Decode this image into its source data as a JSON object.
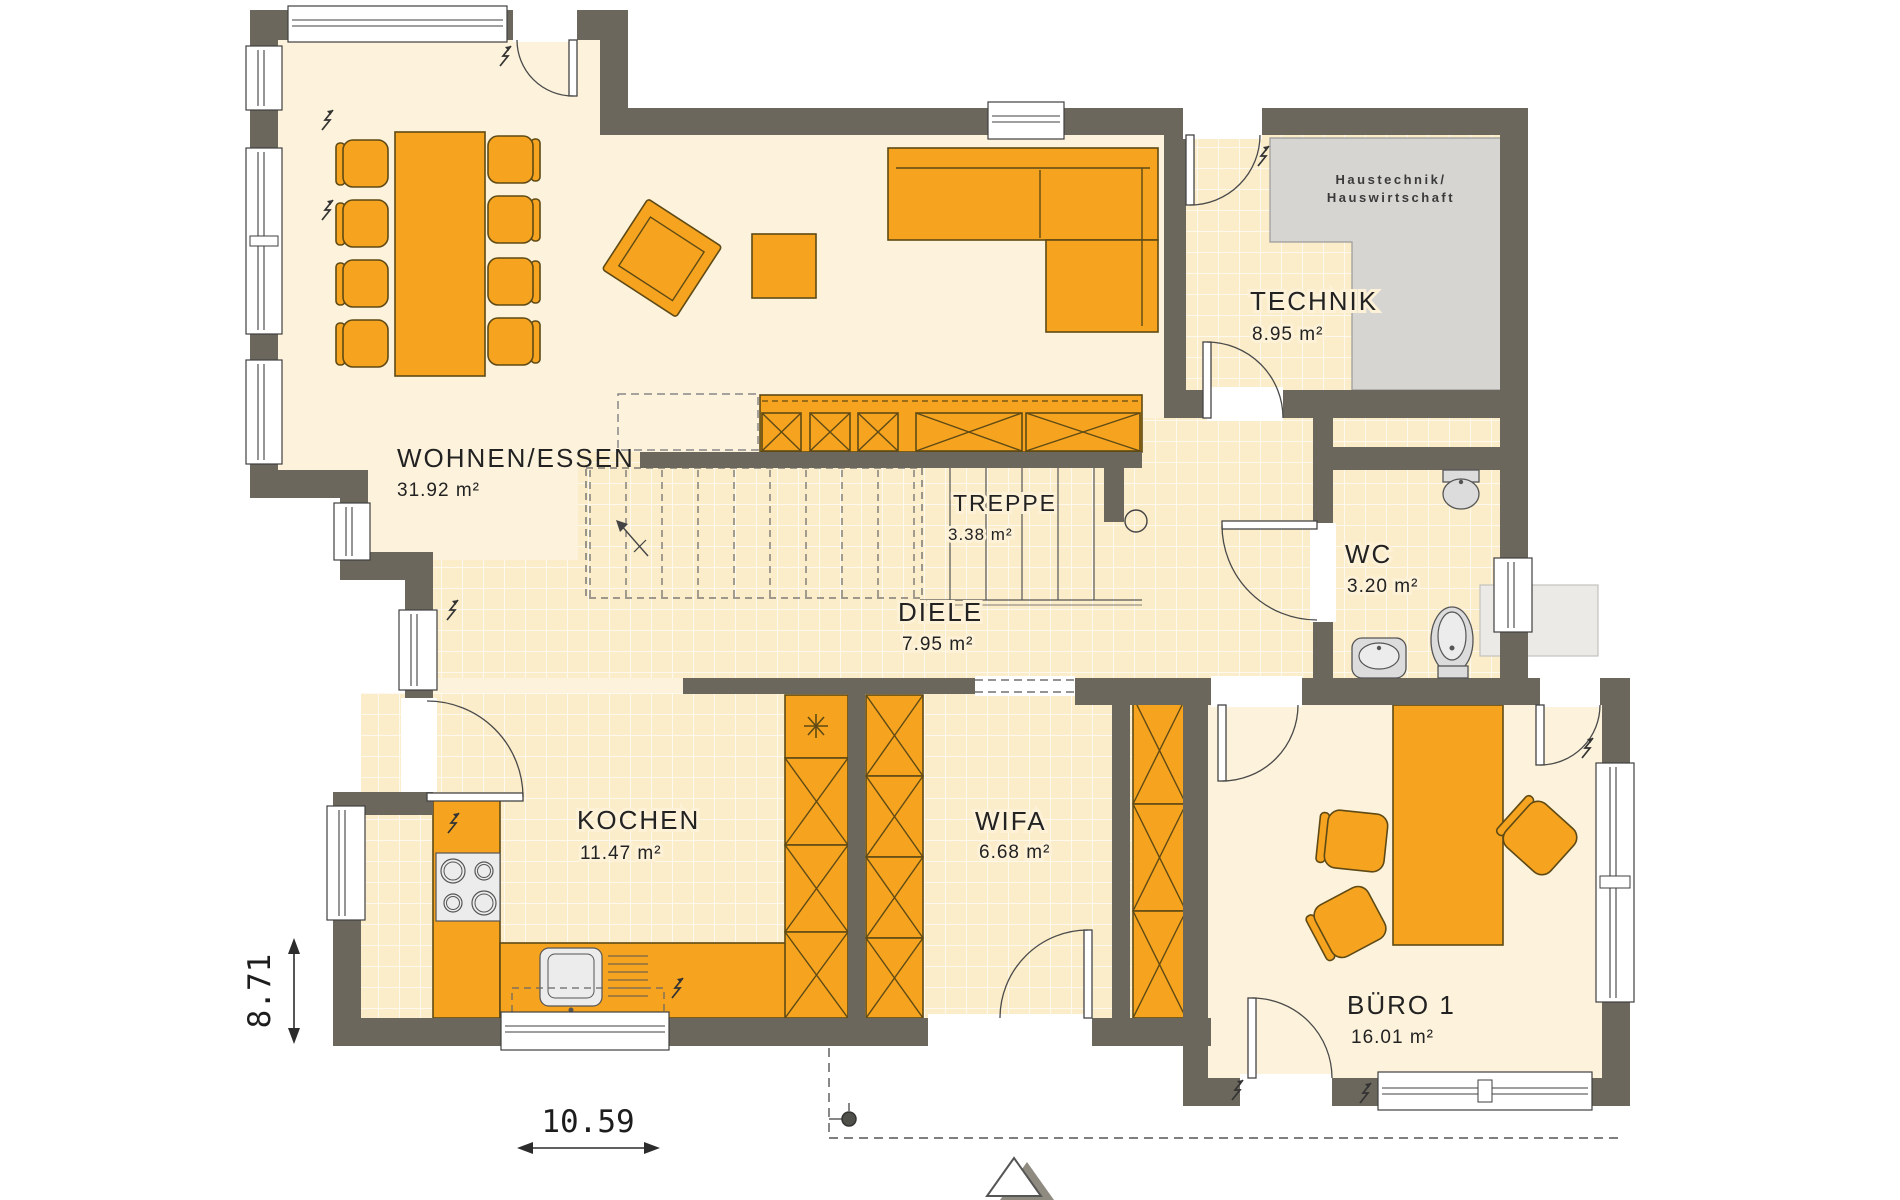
{
  "rooms": {
    "wohnen_essen": {
      "label": "WOHNEN/ESSEN",
      "area": "31.92 m²"
    },
    "technik": {
      "label": "TECHNIK",
      "area": "8.95 m²"
    },
    "treppe": {
      "label": "TREPPE",
      "area": "3.38 m²"
    },
    "diele": {
      "label": "DIELE",
      "area": "7.95 m²"
    },
    "wc": {
      "label": "WC",
      "area": "3.20 m²"
    },
    "kochen": {
      "label": "KOCHEN",
      "area": "11.47 m²"
    },
    "wifa": {
      "label": "WIFA",
      "area": "6.68 m²"
    },
    "buero1": {
      "label": "BÜRO 1",
      "area": "16.01 m²"
    }
  },
  "annotations": {
    "haustechnik_line1": "Haustechnik/",
    "haustechnik_line2": "Hauswirtschaft"
  },
  "dimensions": {
    "width": "10.59",
    "height": "8.71"
  },
  "colors": {
    "wall": "#6b675c",
    "furniture": "#f6a41f",
    "furniture_outline": "#5f4a15",
    "floor": "#fdf3dc",
    "tile_floor": "#fbedca",
    "fixture_gray": "#d8d8d8",
    "haustechnik_gray": "#d6d5d2"
  }
}
